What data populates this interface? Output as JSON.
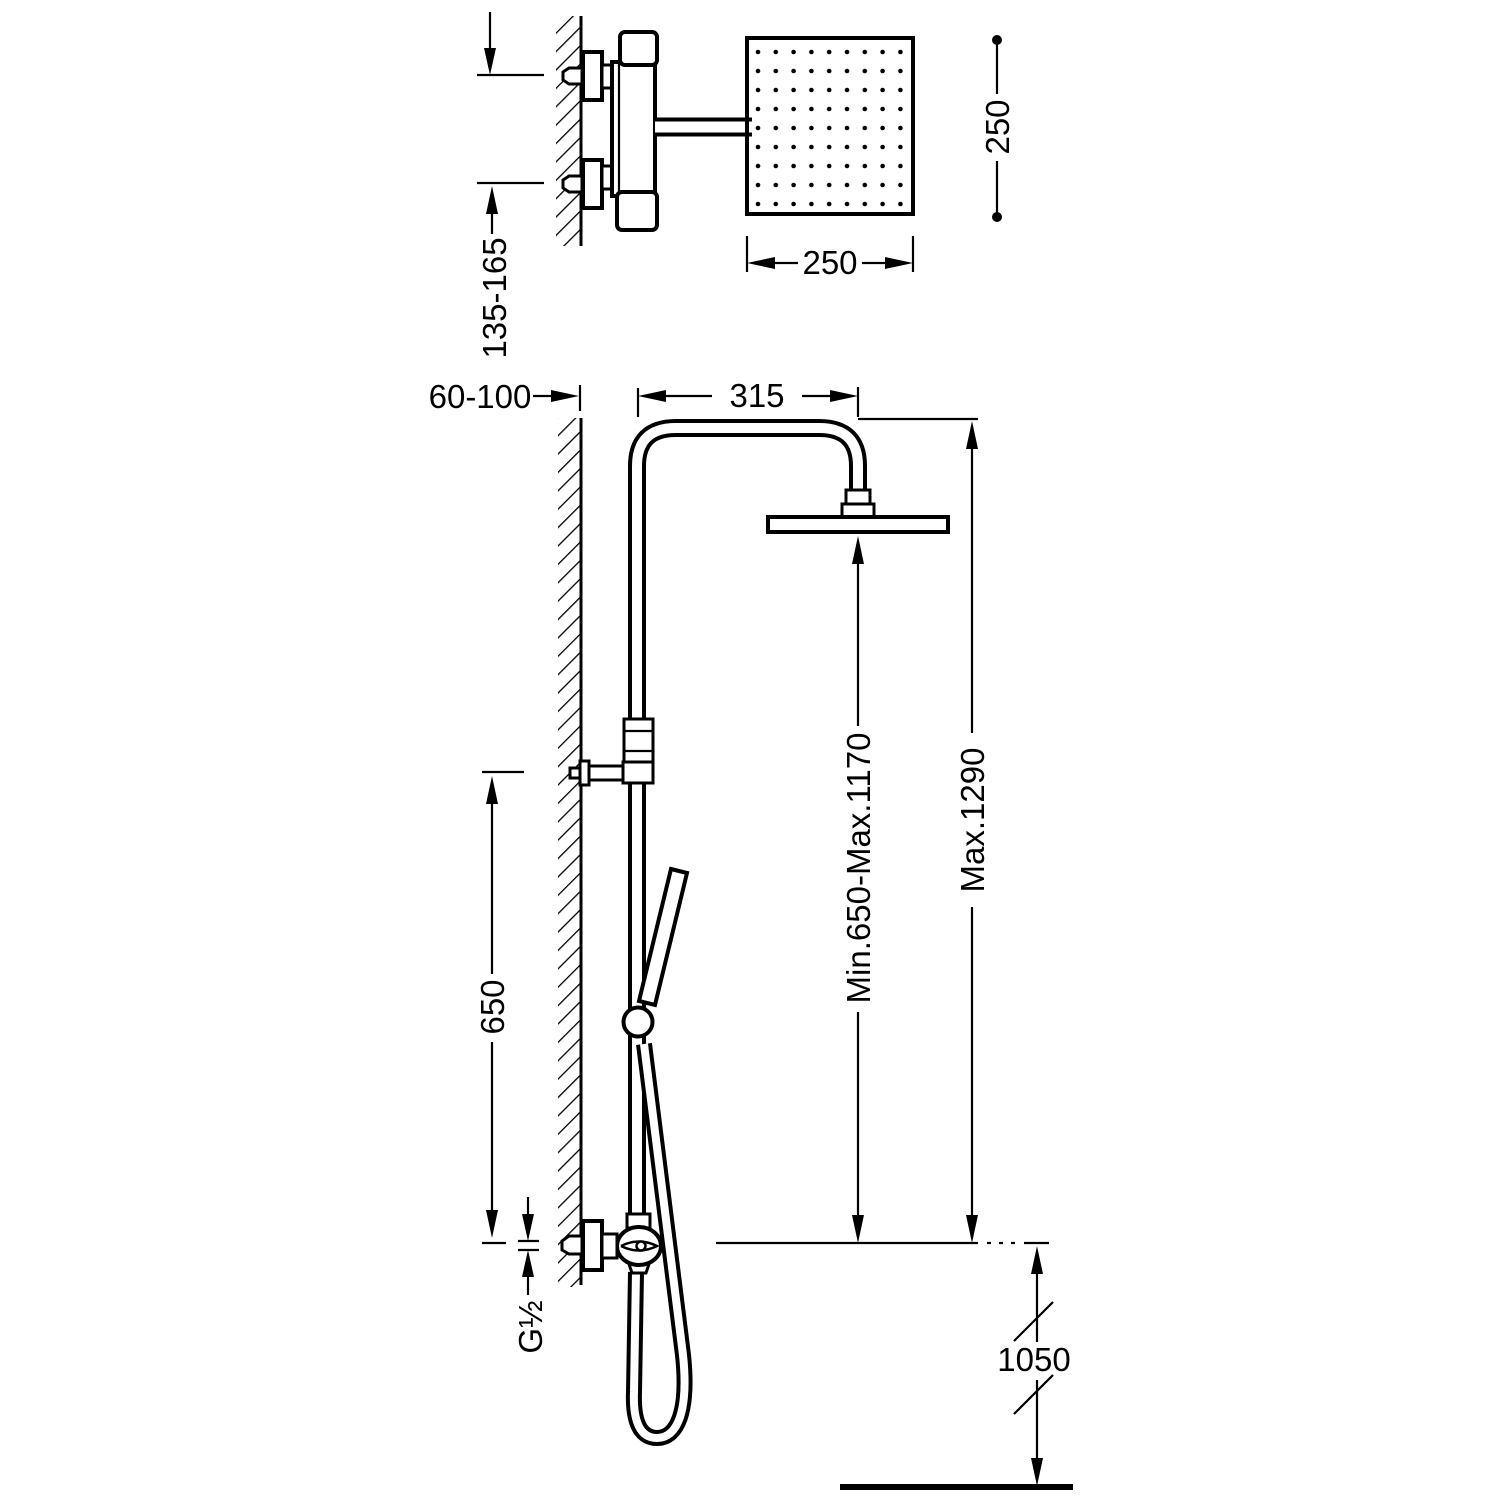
{
  "colors": {
    "ink": "#000000",
    "paper": "#ffffff"
  },
  "views": {
    "top_detail": {
      "inlet_spacing_label": "135-165",
      "head_width_label": "250",
      "head_side_label": "250"
    },
    "front": {
      "wall_offset_label": "60-100",
      "arm_reach_label": "315",
      "head_height_label": "Min.650-Max.1170",
      "column_height_label": "Max.1290",
      "slide_bar_label": "650",
      "thread_label": "G½",
      "outlet_height_label": "1050"
    }
  }
}
